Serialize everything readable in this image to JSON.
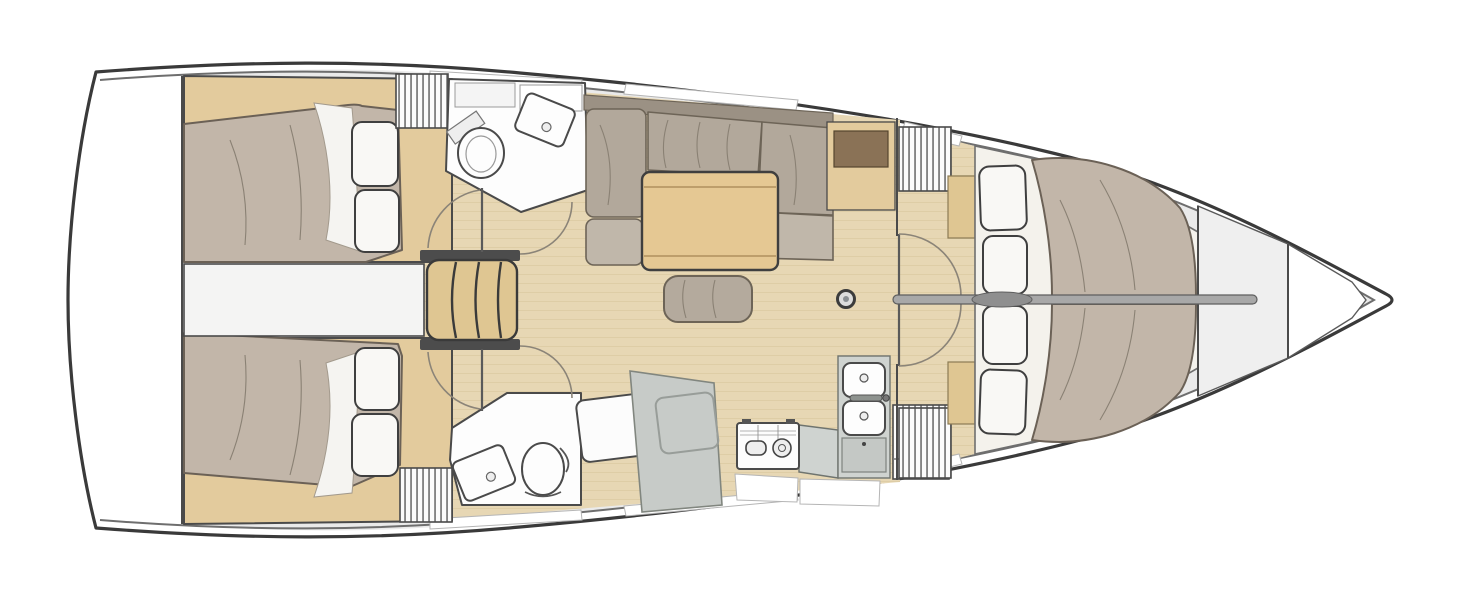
{
  "meta": {
    "title": "Sailing yacht interior layout plan",
    "view": "top-down floor plan",
    "orientation": "bow to the right, stern to the left",
    "layout_summary": "4 cabins, 2 heads: two aft double cabins, aft head to port, forward head with shower and galley to starboard, central saloon with table and settee, split forward V-berth cabins, bow locker"
  },
  "colors": {
    "hull-line": "#3a3a3a",
    "deck-line": "#6e6e6e",
    "deck": "#eaeaea",
    "window": "#ffffff",
    "wall": "#4a4a4a",
    "white": "#fdfdfd",
    "floor": "#e7d7b4",
    "floor-grain": "#cfb98c",
    "joinery": "#e3cb9d",
    "step-wood": "#dfc692",
    "stair-frame": "#4c4c4c",
    "mattress": "#c2b6a9",
    "mattress-line": "#6b6156",
    "bedding": "#f5f4f1",
    "pillow": "#f9f8f5",
    "pillow-line": "#3f3f3f",
    "settee": "#b2a89b",
    "settee-dark": "#9b9184",
    "settee-light": "#c0b7aa",
    "cushion-line": "#6d6457",
    "table": "#e5c893",
    "ottoman": "#b4aa9d",
    "counter": "#cfd3d0",
    "counter-line": "#6f746f",
    "appliance": "#fdfdfd",
    "fixture-line": "#4a4a4a",
    "shower": "#c7cbc8",
    "shower-line": "#81867f",
    "dark-top": "#8a7256",
    "partition": "#a8a8a8",
    "engine-strip": "#f4f4f3",
    "platform": "#f4f2ec",
    "arc": "#8b8478"
  },
  "areas": [
    {
      "id": "aft-cabin-port",
      "name": "Aft double cabin (port)"
    },
    {
      "id": "aft-cabin-starboard",
      "name": "Aft double cabin (starboard)"
    },
    {
      "id": "engine-compartment",
      "name": "Engine space between aft cabins"
    },
    {
      "id": "companionway-stairs",
      "name": "Companionway steps"
    },
    {
      "id": "aft-head",
      "name": "Aft head with toilet and washbasin"
    },
    {
      "id": "saloon",
      "name": "Saloon with L-settee, folding table and ottoman"
    },
    {
      "id": "forward-head",
      "name": "Forward head with toilet and washbasin"
    },
    {
      "id": "shower-stall",
      "name": "Separate shower stall"
    },
    {
      "id": "galley",
      "name": "Galley with stove, double sink and fridge"
    },
    {
      "id": "forward-cabin-port",
      "name": "Forward berth (port half)"
    },
    {
      "id": "forward-cabin-starboard",
      "name": "Forward berth (starboard half)"
    },
    {
      "id": "forepeak",
      "name": "Bow / anchor locker"
    }
  ],
  "furniture": [
    "double berth",
    "pillows",
    "duvet fold",
    "hanging locker (slatted)",
    "toilet",
    "washbasin",
    "shelf",
    "shower pan",
    "dining table",
    "ottoman",
    "settee cushions",
    "chart cabinet",
    "two-burner stove",
    "double sink",
    "faucet",
    "fridge locker",
    "mast post",
    "centerline partition",
    "door swing arcs"
  ]
}
